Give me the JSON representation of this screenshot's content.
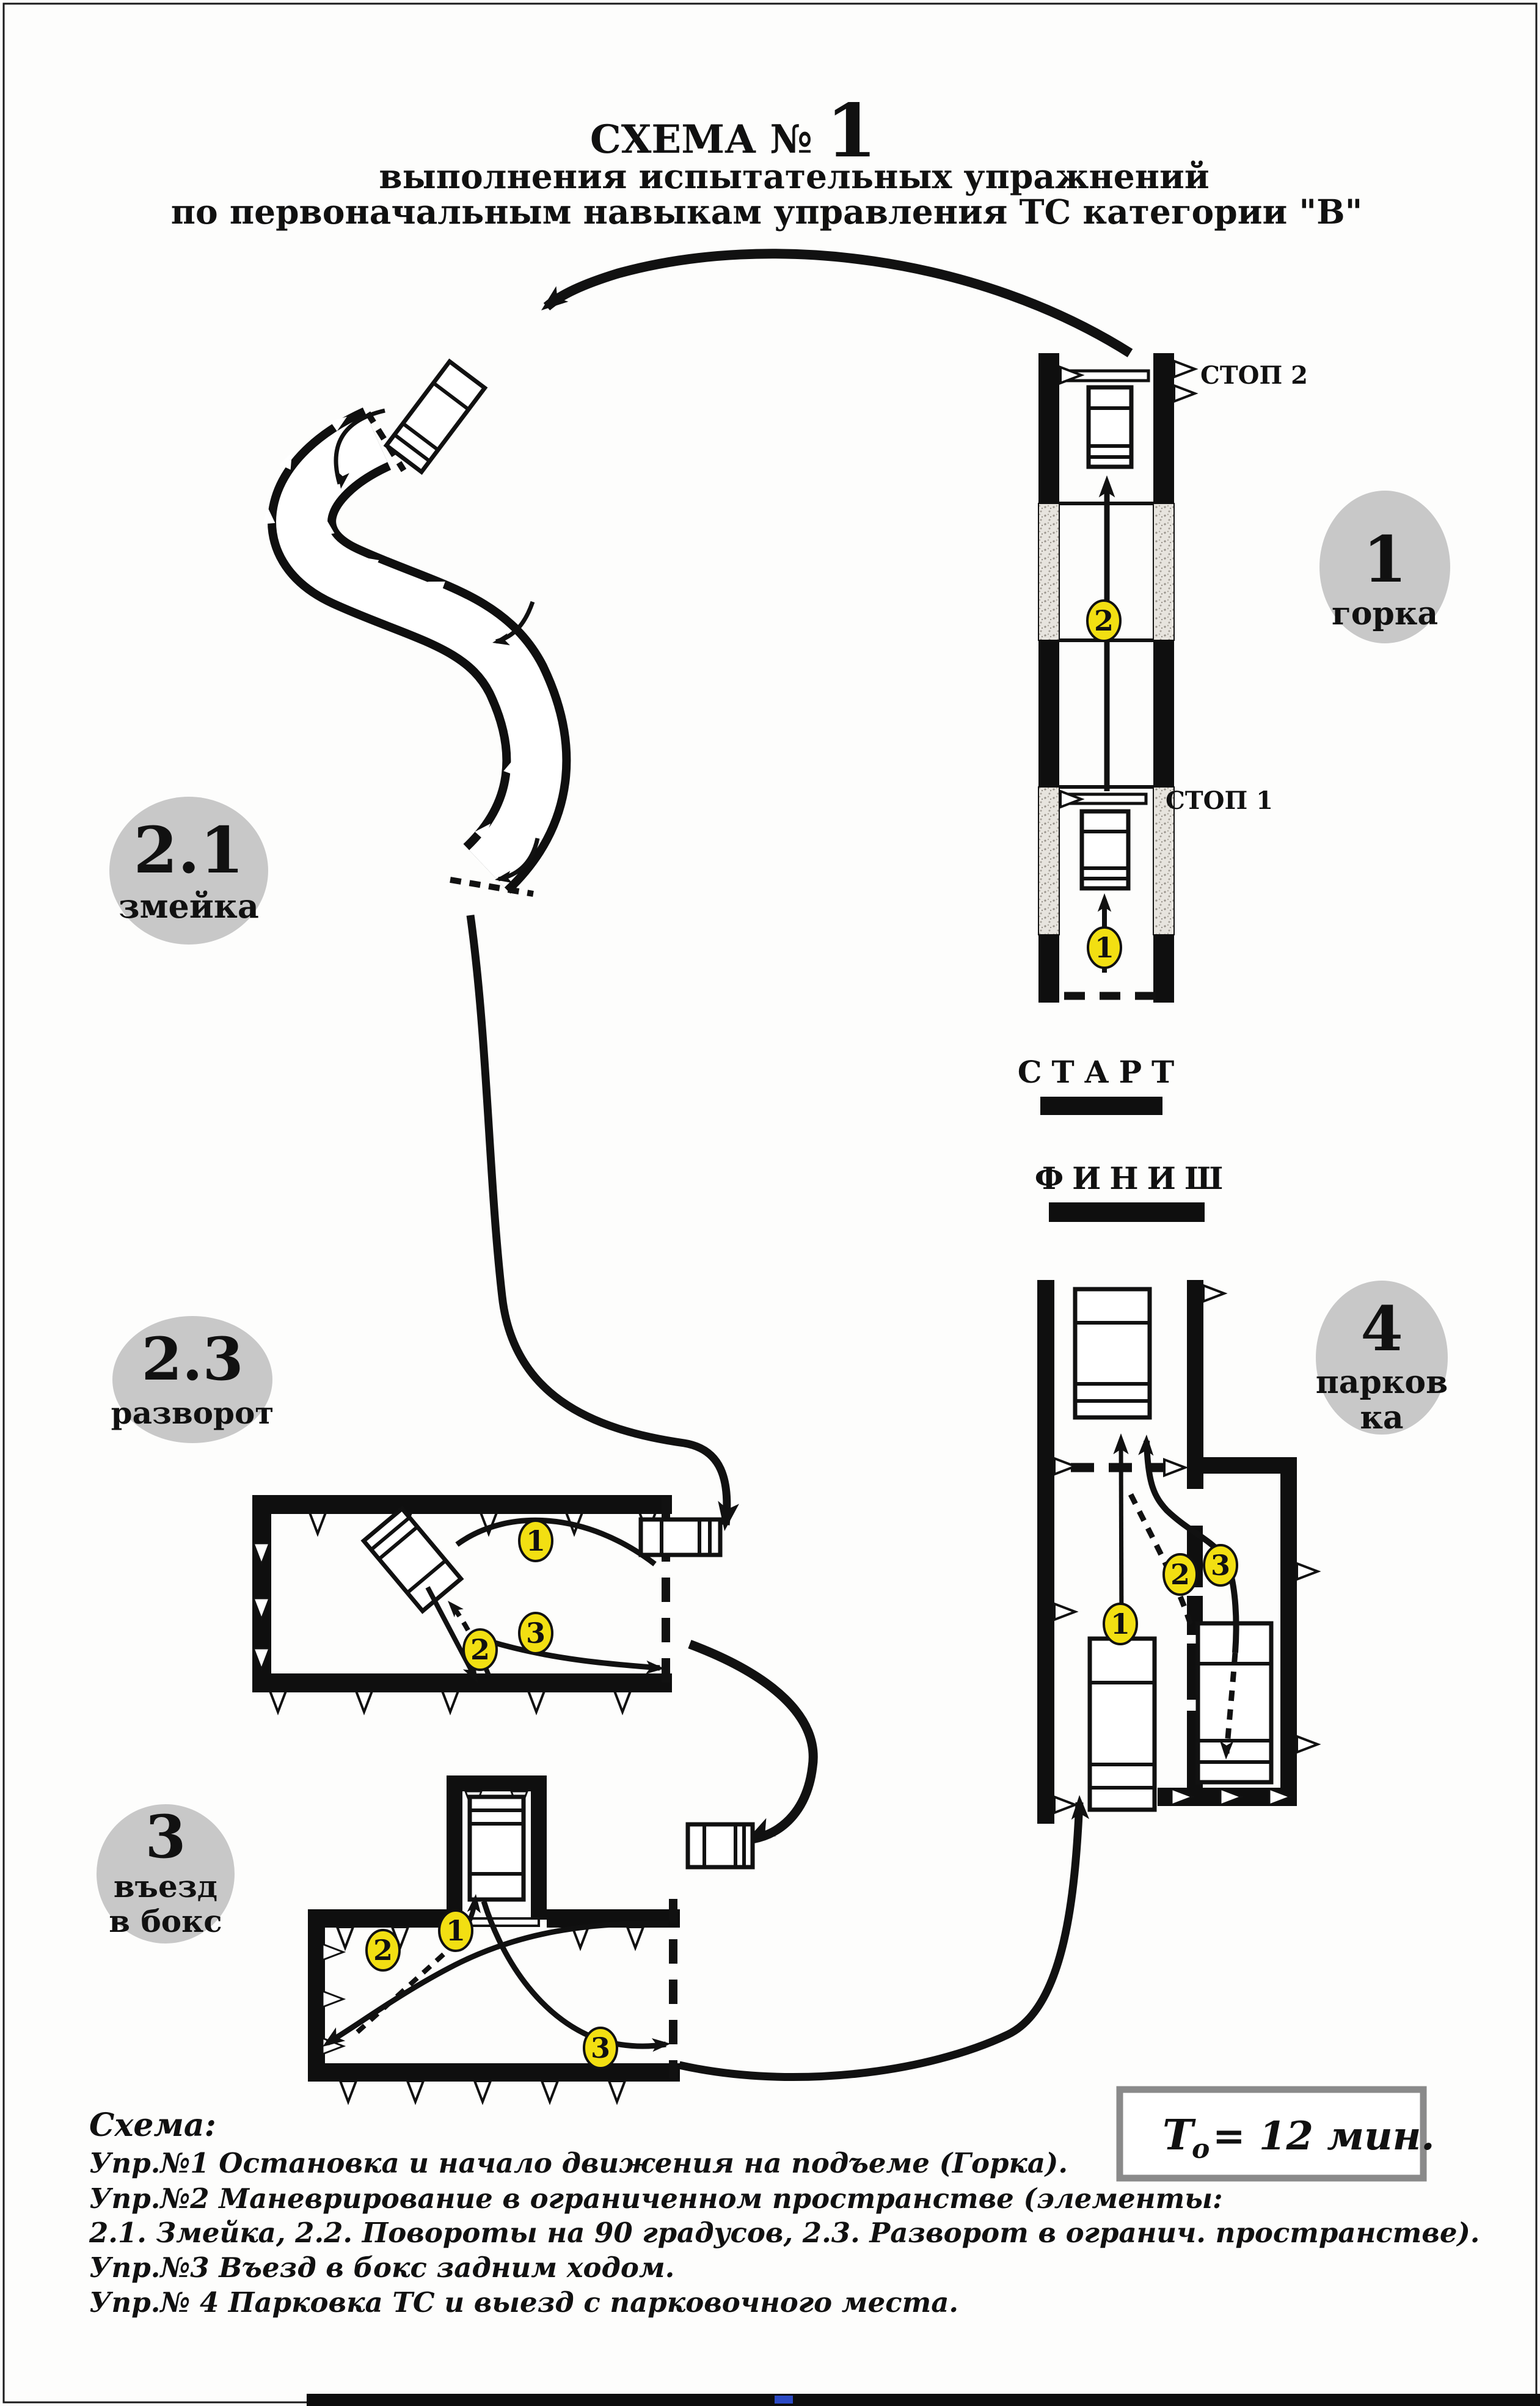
{
  "title": {
    "line1_prefix": "СХЕМА №",
    "line1_number": "1",
    "line2": "выполнения испытательных упражнений",
    "line3": "по первоначальным навыкам управления ТС категории \"В\""
  },
  "start_label": "СТАРТ",
  "finish_label": "ФИНИШ",
  "exercises": {
    "gorka": {
      "circle_number": "1",
      "circle_label": "горка",
      "stop2": "СТОП 2",
      "stop1": "СТОП 1",
      "markers": [
        "1",
        "2"
      ]
    },
    "zmeyka": {
      "circle_number": "2.1",
      "circle_label": "змейка"
    },
    "razvorot": {
      "circle_number": "2.3",
      "circle_label": "разворот",
      "markers": [
        "1",
        "2",
        "3"
      ]
    },
    "boks": {
      "circle_number": "3",
      "circle_label_line1": "въезд",
      "circle_label_line2": "в бокс",
      "markers": [
        "1",
        "2",
        "3"
      ]
    },
    "parkovka": {
      "circle_number": "4",
      "circle_label_line1": "парков",
      "circle_label_line2": "ка",
      "markers": [
        "1",
        "2",
        "3"
      ]
    }
  },
  "time_box": {
    "symbol": "Т",
    "subscript": "о",
    "value": "= 12 мин."
  },
  "legend": {
    "header": "Схема:",
    "lines": [
      "Упр.№1 Остановка и начало движения на подъеме (Горка).",
      "Упр.№2 Маневрирование в ограниченном пространстве (элементы:",
      "2.1. Змейка, 2.2. Повороты на 90 градусов, 2.3. Разворот в огранич. пространстве).",
      "Упр.№3 Въезд в бокс задним ходом.",
      "Упр.№ 4 Парковка ТС и выезд с парковочного места."
    ]
  },
  "colors": {
    "marker_yellow": "#f2df12",
    "circle_grey": "#c8c8c8",
    "ink": "#111111",
    "time_border": "#8a8a8a"
  }
}
